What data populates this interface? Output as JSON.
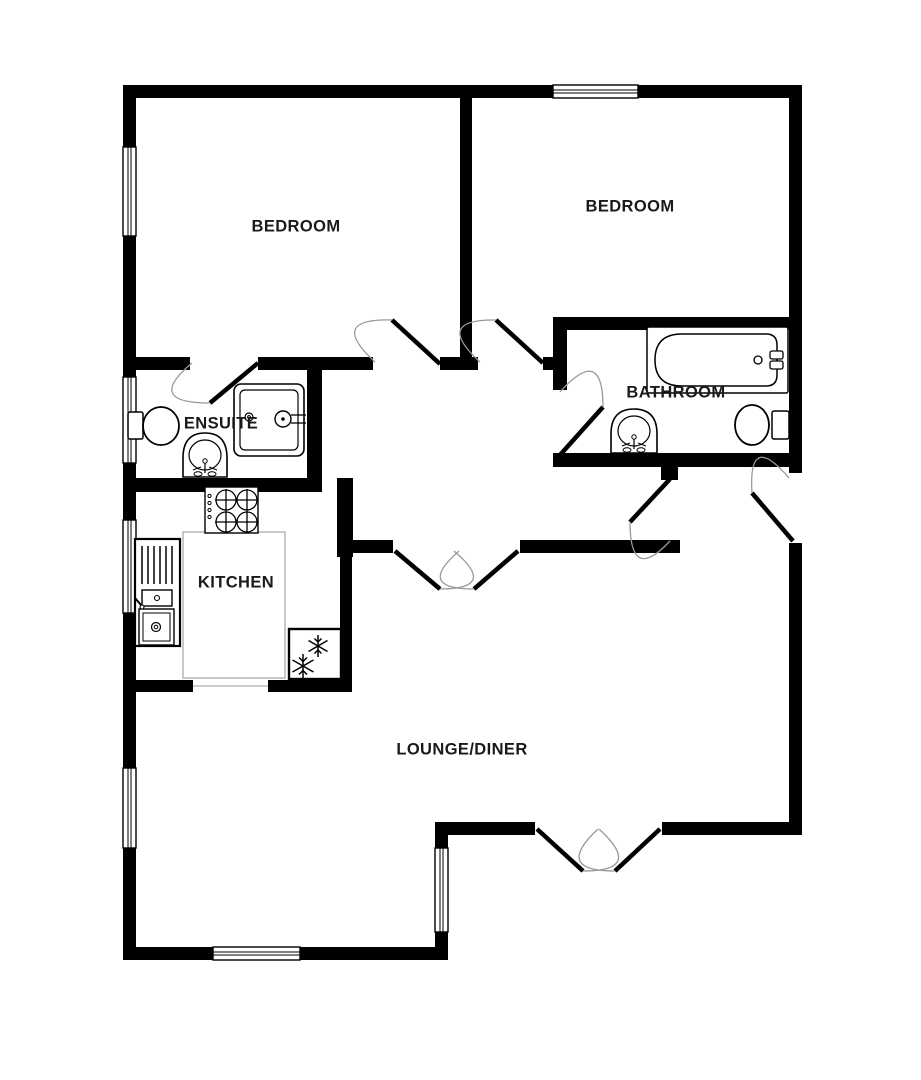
{
  "plan": {
    "type": "residential-floorplan",
    "colors": {
      "background": "#ffffff",
      "wall": "#000000",
      "door_leaf": "#000000",
      "door_arc": "#999999",
      "counter_outline": "#aaaaaa",
      "fixture_line": "#000000",
      "label_text": "#1a1a1a"
    },
    "rooms": [
      {
        "id": "bedroom-left",
        "label": "BEDROOM"
      },
      {
        "id": "bedroom-right",
        "label": "BEDROOM"
      },
      {
        "id": "bathroom",
        "label": "BATHROOM"
      },
      {
        "id": "ensuite",
        "label": "ENSUITE"
      },
      {
        "id": "kitchen",
        "label": "KITCHEN"
      },
      {
        "id": "lounge-diner",
        "label": "LOUNGE/DINER"
      }
    ],
    "fixtures": [
      "bathtub",
      "bathroom-sink",
      "bathroom-toilet",
      "ensuite-toilet",
      "ensuite-sink",
      "shower-enclosure",
      "stove-hob",
      "kitchen-sink-unit",
      "fridge-freezer",
      "kitchen-counter"
    ]
  }
}
